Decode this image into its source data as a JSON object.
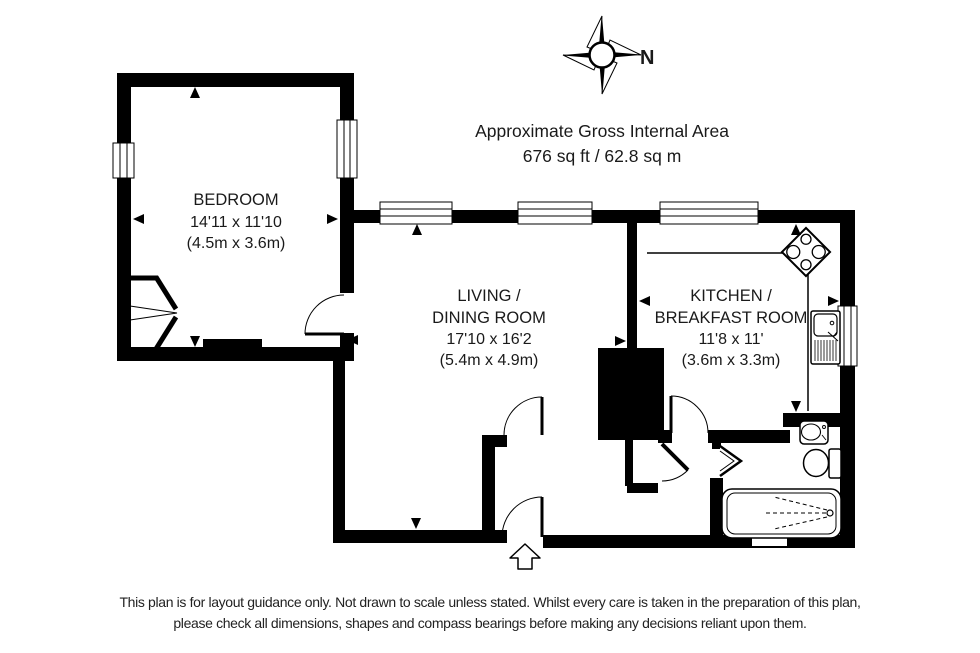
{
  "header": {
    "title": "Approximate Gross Internal Area",
    "area": "676 sq ft / 62.8 sq m"
  },
  "compass": {
    "north_label": "N"
  },
  "rooms": {
    "bedroom": {
      "name": "BEDROOM",
      "size_imperial": "14'11 x 11'10",
      "size_metric": "(4.5m x 3.6m)"
    },
    "living_dining": {
      "name_line1": "LIVING /",
      "name_line2": "DINING ROOM",
      "size_imperial": "17'10 x 16'2",
      "size_metric": "(5.4m x 4.9m)"
    },
    "kitchen_breakfast": {
      "name_line1": "KITCHEN /",
      "name_line2": "BREAKFAST ROOM",
      "size_imperial": "11'8 x 11'",
      "size_metric": "(3.6m x 3.3m)"
    }
  },
  "disclaimer": {
    "line1": "This plan is for layout guidance only. Not drawn to scale unless stated. Whilst every care is taken in the preparation of this plan,",
    "line2": "please check all dimensions, shapes and compass bearings before making any decisions reliant upon them."
  },
  "colors": {
    "wall": "#000000",
    "background": "#ffffff",
    "text": "#1a1a1a"
  }
}
